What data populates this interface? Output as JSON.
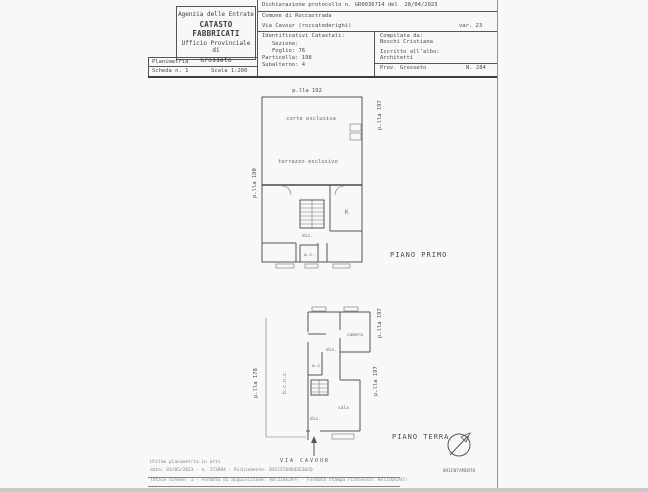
{
  "header": {
    "agency": {
      "line1": "Agenzia delle Entrate",
      "line2": "CATASTO FABBRICATI",
      "line3": "Ufficio Provinciale di",
      "line4": "Grosseto"
    },
    "protocol": "Dichiarazione protocollo n. GR0036714 del  28/04/2023",
    "comune": "Comune di Roccastrada",
    "address": "Via Cavour (roccatederighi)",
    "variation": "var. 23",
    "catasto": {
      "title": "Identificativi Catastali:",
      "sezione": "Sezione:",
      "foglio": "Foglio: 76",
      "particella": "Particella: 198",
      "subalterno": "Subalterno: 4"
    },
    "compiler": {
      "label": "Compilata da:",
      "name": "Boschi Cristiana",
      "albo_label": "Iscritto all'albo:",
      "albo": "Architetti",
      "prov": "Prov. Grosseto",
      "number": "N. 284"
    },
    "planimetria": {
      "title": "Planimetria",
      "scheda": "Scheda n. 1",
      "scala": "Scala 1:200"
    }
  },
  "plan_primo": {
    "title": "PIANO PRIMO",
    "parcel_top": "p.lla 192",
    "parcel_right": "p.lla 197",
    "parcel_left": "p.lla 190",
    "room_corte": "corte esclusiva",
    "room_terrazzo": "terrazzo esclusivo",
    "room_k": "K",
    "room_dis": "dis.",
    "room_wc": "w.c."
  },
  "plan_terra": {
    "title": "PIANO TERRA",
    "parcel_right_top": "p.lla 197",
    "parcel_right_bottom": "p.lla 197",
    "parcel_left": "p.lla 178",
    "court_label": "b.c.n.c.",
    "room_camera": "camera",
    "room_dis_top": "dis.",
    "room_wc": "w.c.",
    "room_sala": "sala",
    "room_dis_bottom": "dis.",
    "street": "VIA CAVOUR"
  },
  "compass_label": "ORIENTAMENTO",
  "footer": {
    "line1": "Ultima planimetria in atti",
    "line2": "data: 03/05/2023 - n. 173894 - Richiedente: BSCCST69D42E202Q",
    "line3": "Totale schede: 1 - Formato di acquisizione: A4(210x297) - Formato stampa richiesto: A4(210x297)"
  }
}
